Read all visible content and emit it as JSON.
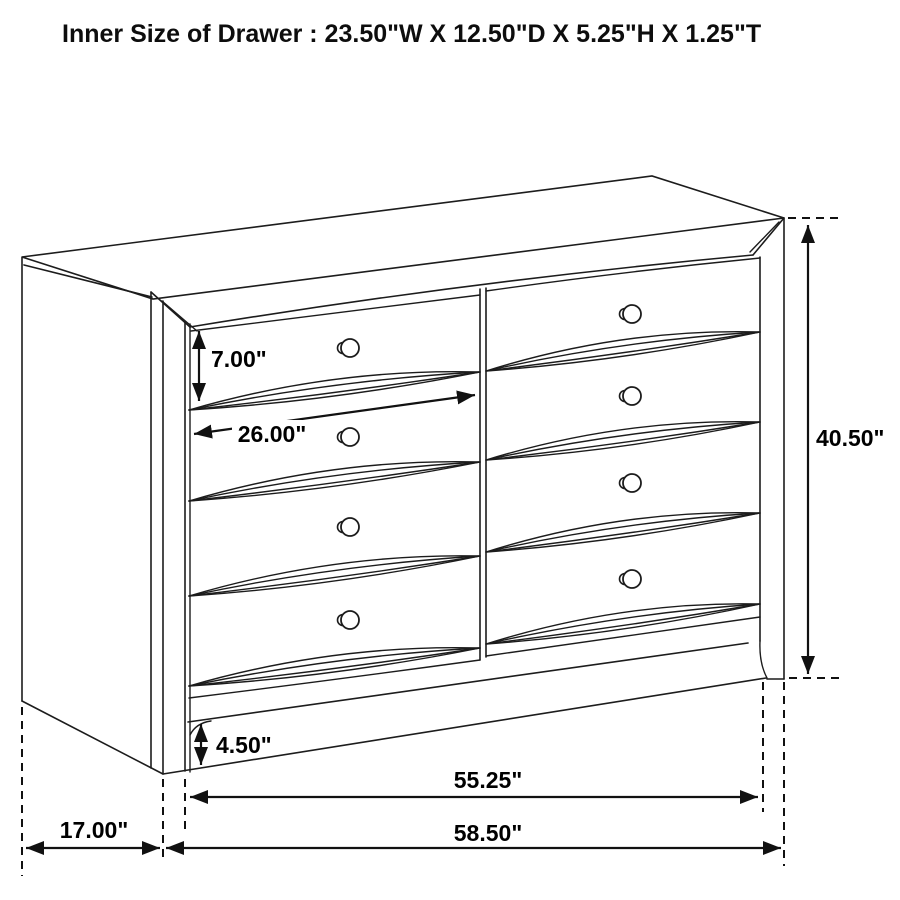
{
  "title": "Inner Size of Drawer : 23.50\"W X 12.50\"D X 5.25\"H X 1.25\"T",
  "dimensions": {
    "drawer_opening_height": "7.00\"",
    "drawer_opening_width": "26.00\"",
    "overall_height": "40.50\"",
    "base_height": "4.50\"",
    "front_width": "55.25\"",
    "overall_width": "58.50\"",
    "side_depth": "17.00\""
  },
  "colors": {
    "line": "#1c1c1c",
    "background": "#ffffff",
    "text": "#000000"
  }
}
